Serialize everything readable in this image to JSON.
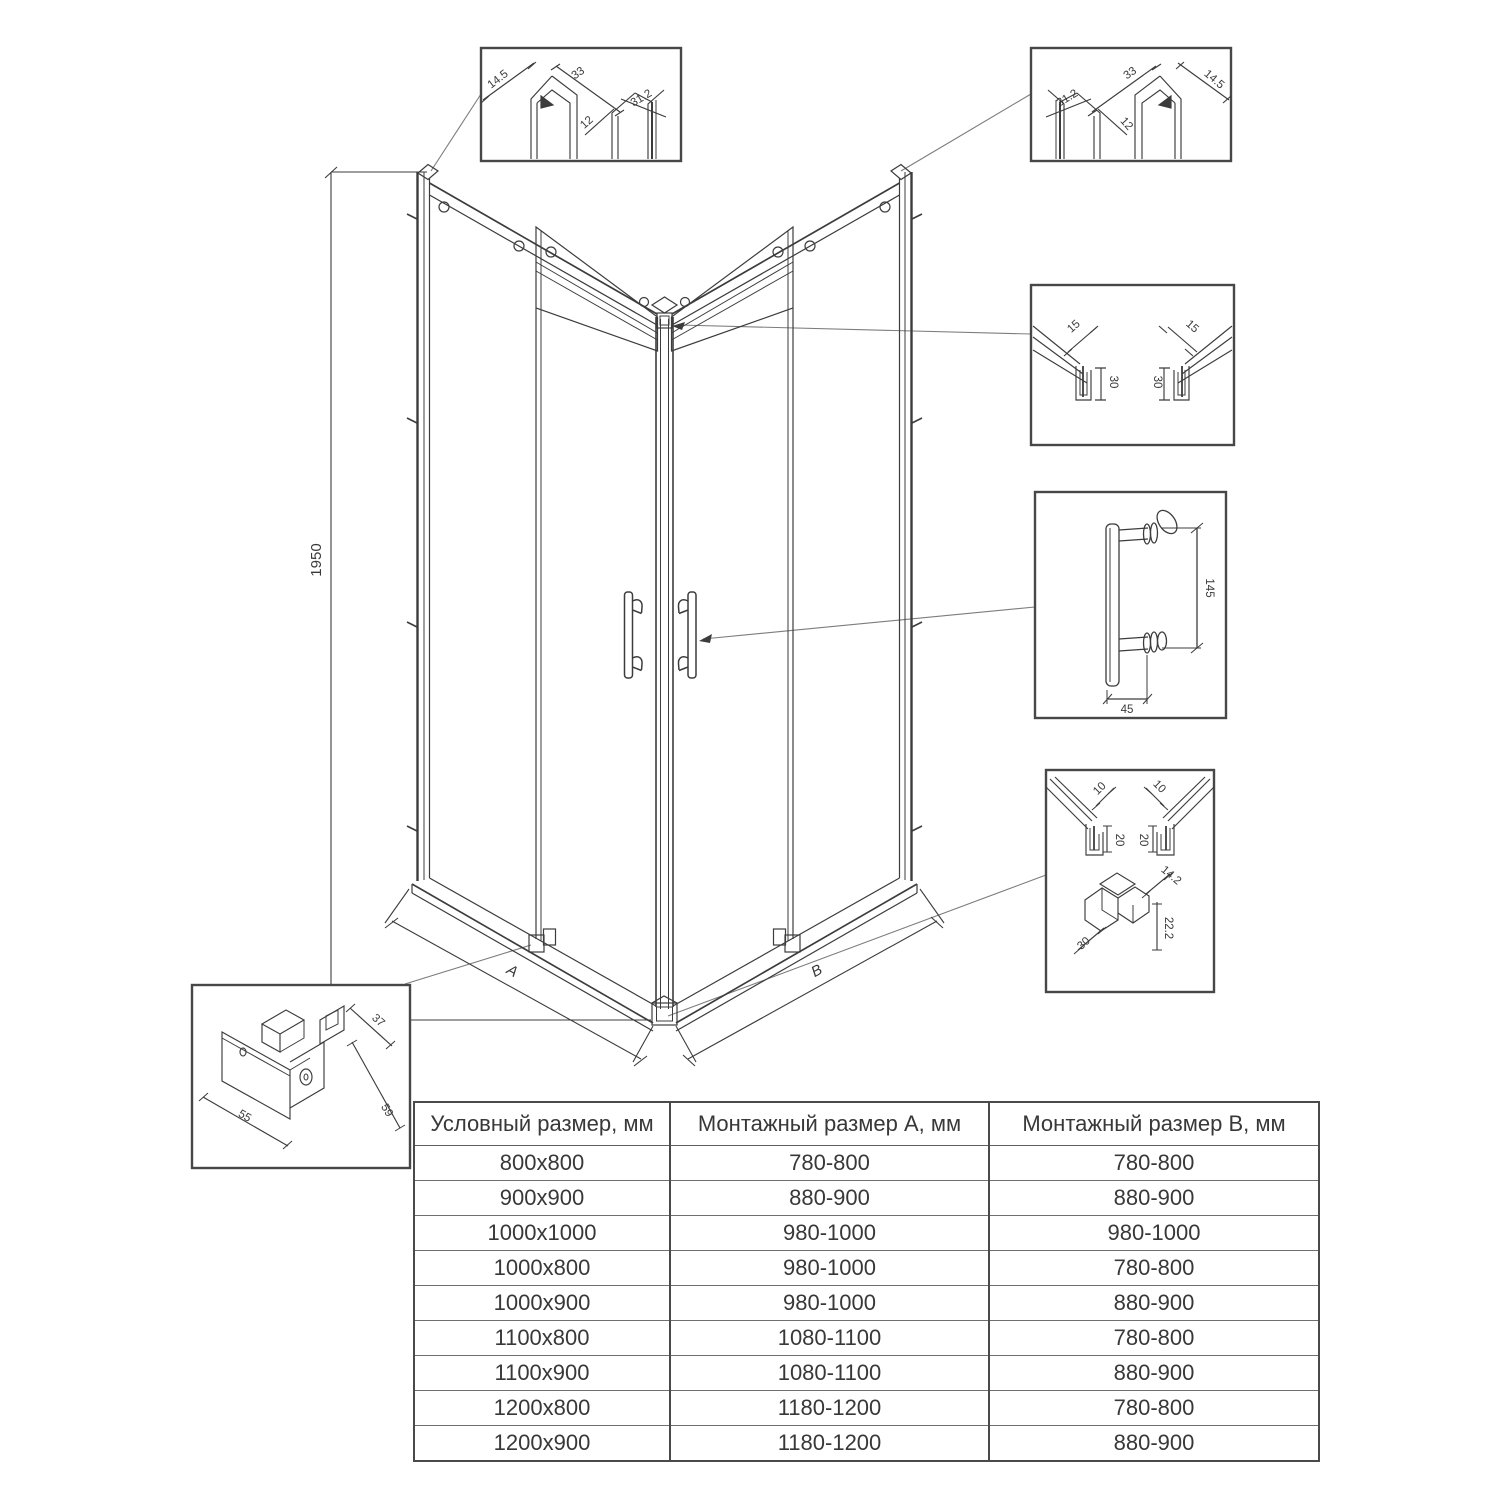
{
  "drawing": {
    "height_dim": "1950",
    "dim_a": "A",
    "dim_b": "B"
  },
  "details": {
    "top_left_profile": {
      "d14_5": "14.5",
      "d33": "33",
      "d12": "12",
      "d31_2": "31.2"
    },
    "top_right_profile": {
      "d31_2": "31.2",
      "d12": "12",
      "d33": "33",
      "d14_5": "14.5"
    },
    "corner_profile": {
      "d15_left": "15",
      "d30_left": "30",
      "d15_right": "15",
      "d30_right": "30"
    },
    "handle": {
      "d145": "145",
      "d45": "45"
    },
    "bottom_assembly": {
      "d10_left": "10",
      "d10_right": "10",
      "d20_left": "20",
      "d20_right": "20",
      "d14_2": "14.2",
      "d22_2": "22.2",
      "d30": "30"
    },
    "roller_block": {
      "d37": "37",
      "d55": "55",
      "d59": "59"
    }
  },
  "table": {
    "headers": [
      "Условный размер, мм",
      "Монтажный размер A, мм",
      "Монтажный размер B, мм"
    ],
    "rows": [
      [
        "800x800",
        "780-800",
        "780-800"
      ],
      [
        "900x900",
        "880-900",
        "880-900"
      ],
      [
        "1000x1000",
        "980-1000",
        "980-1000"
      ],
      [
        "1000x800",
        "980-1000",
        "780-800"
      ],
      [
        "1000x900",
        "980-1000",
        "880-900"
      ],
      [
        "1100x800",
        "1080-1100",
        "780-800"
      ],
      [
        "1100x900",
        "1080-1100",
        "880-900"
      ],
      [
        "1200x800",
        "1180-1200",
        "780-800"
      ],
      [
        "1200x900",
        "1180-1200",
        "880-900"
      ]
    ]
  }
}
